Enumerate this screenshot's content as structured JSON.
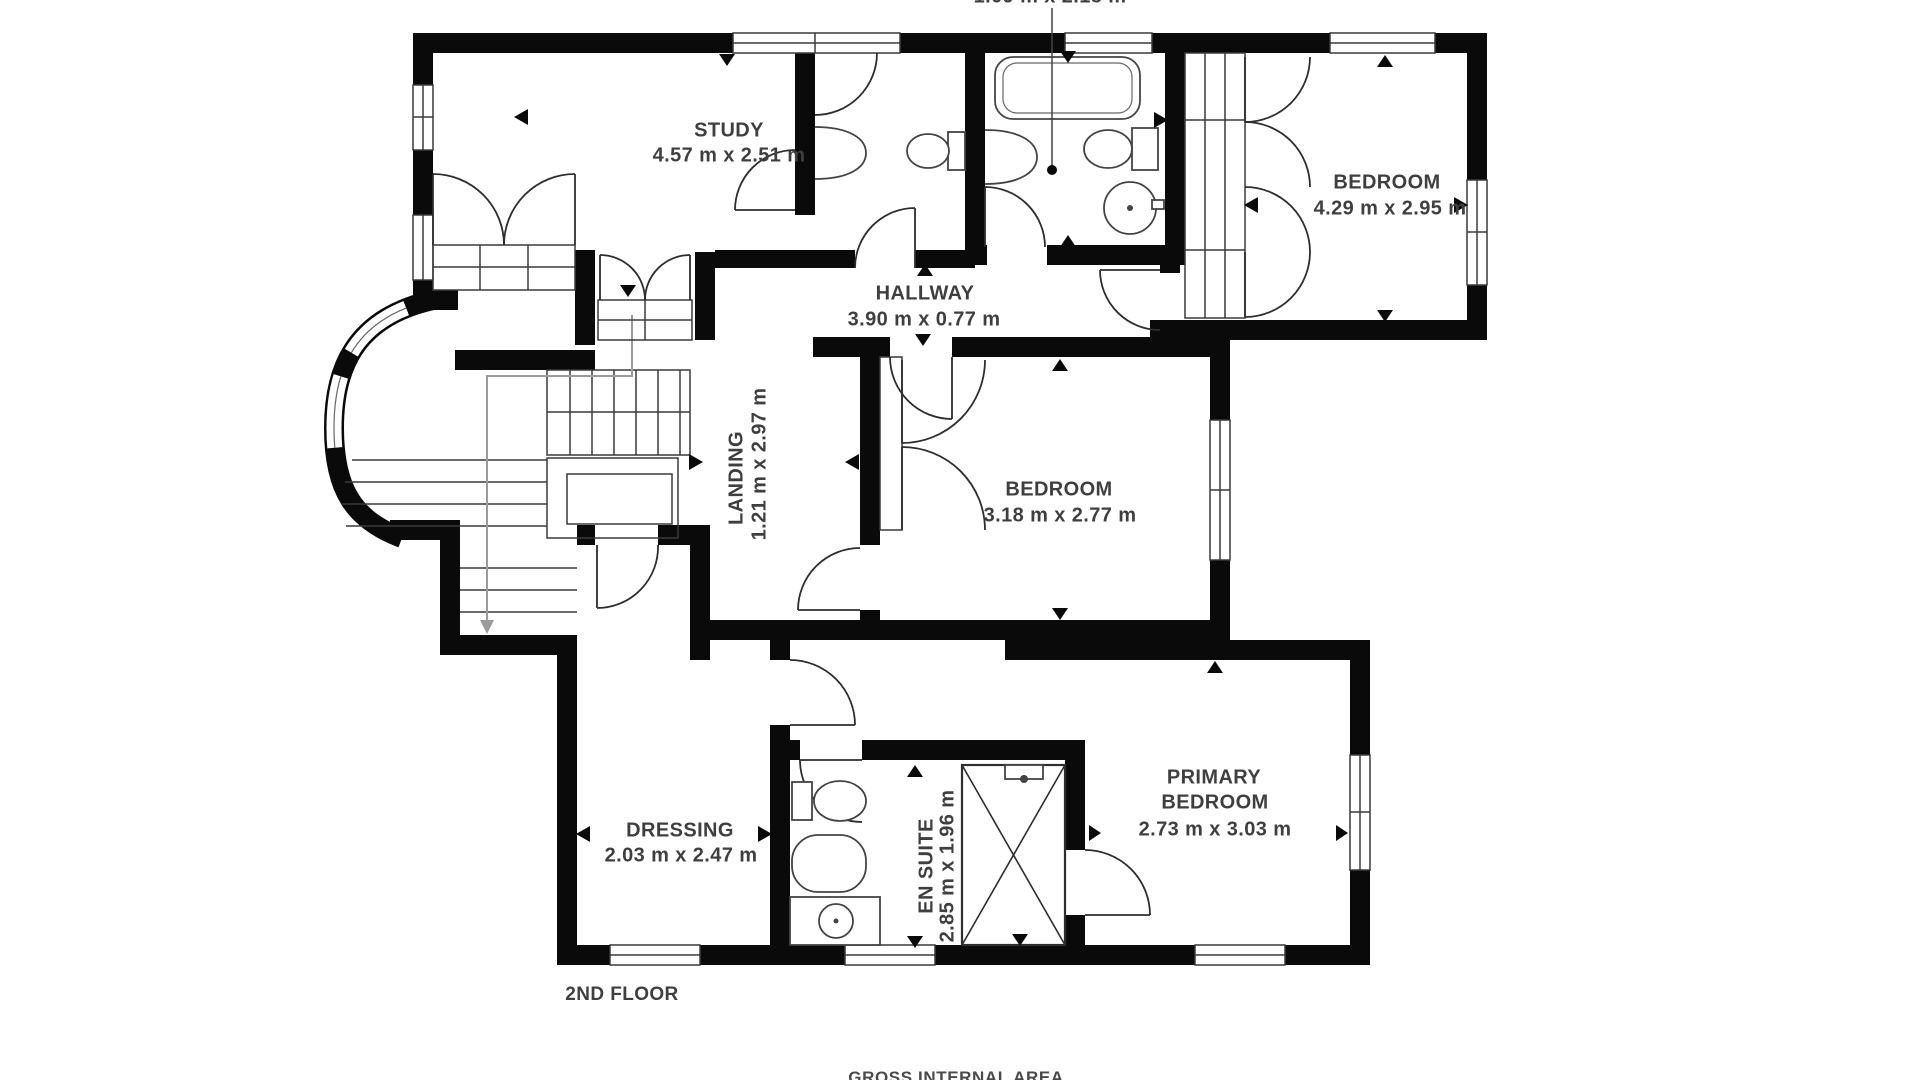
{
  "floor_plan": {
    "floor_label": "2ND FLOOR",
    "footer_label": "GROSS INTERNAL AREA",
    "rooms": {
      "bathroom": {
        "dims": "1.09 m x 2.18 m"
      },
      "study": {
        "name": "STUDY",
        "dims": "4.57 m x 2.51 m"
      },
      "bedroom_top_right": {
        "name": "BEDROOM",
        "dims": "4.29 m x 2.95 m"
      },
      "hallway": {
        "name": "HALLWAY",
        "dims": "3.90 m x 0.77 m"
      },
      "landing": {
        "name": "LANDING",
        "dims": "1.21 m x 2.97 m"
      },
      "bedroom_middle": {
        "name": "BEDROOM",
        "dims": "3.18 m x 2.77 m"
      },
      "dressing": {
        "name": "DRESSING",
        "dims": "2.03 m x 2.47 m"
      },
      "en_suite": {
        "name": "EN SUITE",
        "dims": "2.85 m x 1.96 m"
      },
      "primary_bedroom": {
        "name_line1": "PRIMARY",
        "name_line2": "BEDROOM",
        "dims": "2.73 m x 3.03 m"
      }
    },
    "colors": {
      "wall": "#0a0a0a",
      "label_text": "#3f3f3f"
    }
  }
}
